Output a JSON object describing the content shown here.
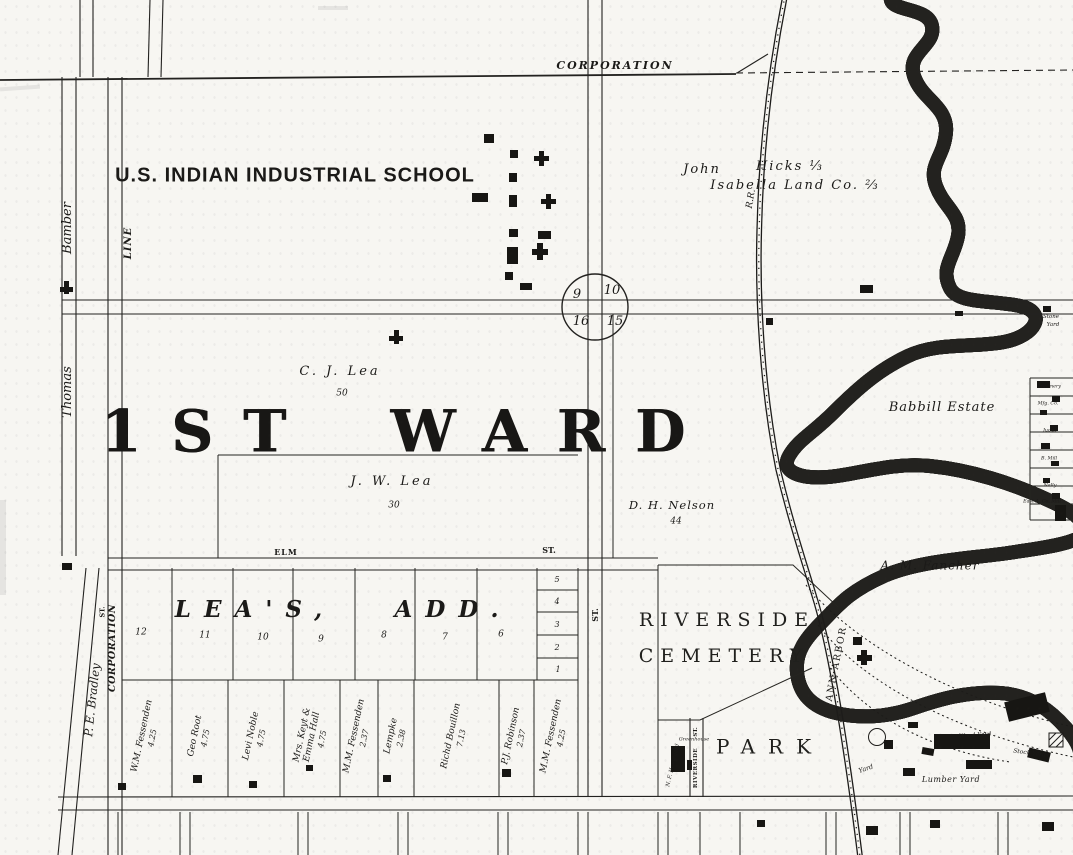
{
  "title_labels": {
    "corporation_top": "CORPORATION",
    "school": "U.S. INDIAN INDUSTRIAL SCHOOL",
    "ward": "1ST WARD"
  },
  "owners": {
    "john": "John",
    "hicks": "Hicks ⅓",
    "isabella": "Isabella Land Co. ⅔",
    "cj_lea": "C. J. Lea",
    "cj_lea_acres": "50",
    "jw_lea": "J. W. Lea",
    "jw_lea_acres": "30",
    "nelson": "D. H. Nelson",
    "nelson_acres": "44",
    "babbill": "Babbill Estate",
    "fancher": "A. M. Fancher"
  },
  "streets": {
    "bamber": "Bamber",
    "line": "LINE",
    "thomas": "Thomas",
    "corporation_w": "CORPORATION",
    "corporation_w_st": "ST.",
    "bradley": "P. E. Bradley",
    "elm": "ELM",
    "elm_st": "ST.",
    "mid_st": "ST.",
    "riverside": "RIVERSIDE",
    "riverside_st": "ST."
  },
  "sections": {
    "nw": "9",
    "ne": "10",
    "sw": "16",
    "se": "15"
  },
  "addition": {
    "name_left": "LEA'S,",
    "name_right": "ADD.",
    "block_lots": [
      "12",
      "11",
      "10",
      "9",
      "8",
      "7",
      "6"
    ],
    "small_lots": [
      "5",
      "4",
      "3",
      "2",
      "1"
    ]
  },
  "south_lots": [
    {
      "name": "W.M. Fessenden",
      "acres": "4.25"
    },
    {
      "name": "Geo Root",
      "acres": "4.75"
    },
    {
      "name": "Levi Noble",
      "acres": "4.75"
    },
    {
      "name": "Mrs. Keyt & Emma Hall",
      "acres": "4.75"
    },
    {
      "name": "M.M. Fessenden",
      "acres": "2.37"
    },
    {
      "name": "Lempke",
      "acres": "2.38"
    },
    {
      "name": "Richd Bouillon",
      "acres": "7.13"
    },
    {
      "name": "P.J. Robinson",
      "acres": "2.37"
    },
    {
      "name": "M.M. Fessenden",
      "acres": "4.25"
    }
  ],
  "cemetery": {
    "line1": "RIVERSIDE",
    "line2": "CEMETERY"
  },
  "park": "PARK",
  "railroad": {
    "ann_arbor": "ANN ARBOR",
    "rr": "R.R."
  },
  "yards": {
    "stone_1": "Stone",
    "stone_2": "Yard",
    "lumber": "Lumber Yard",
    "wood": "Wood Yard",
    "stock": "Stock Yards",
    "yard": "Yard"
  },
  "small_sites": {
    "greenhouse": "Greenhouse",
    "homestead": "N. F. Homegard",
    "homestead_num": "2",
    "edge": [
      "Creamery",
      "Mfg. Co.",
      "Judge",
      "B. Mill",
      "Nally",
      "East A. Co. Mill"
    ]
  }
}
